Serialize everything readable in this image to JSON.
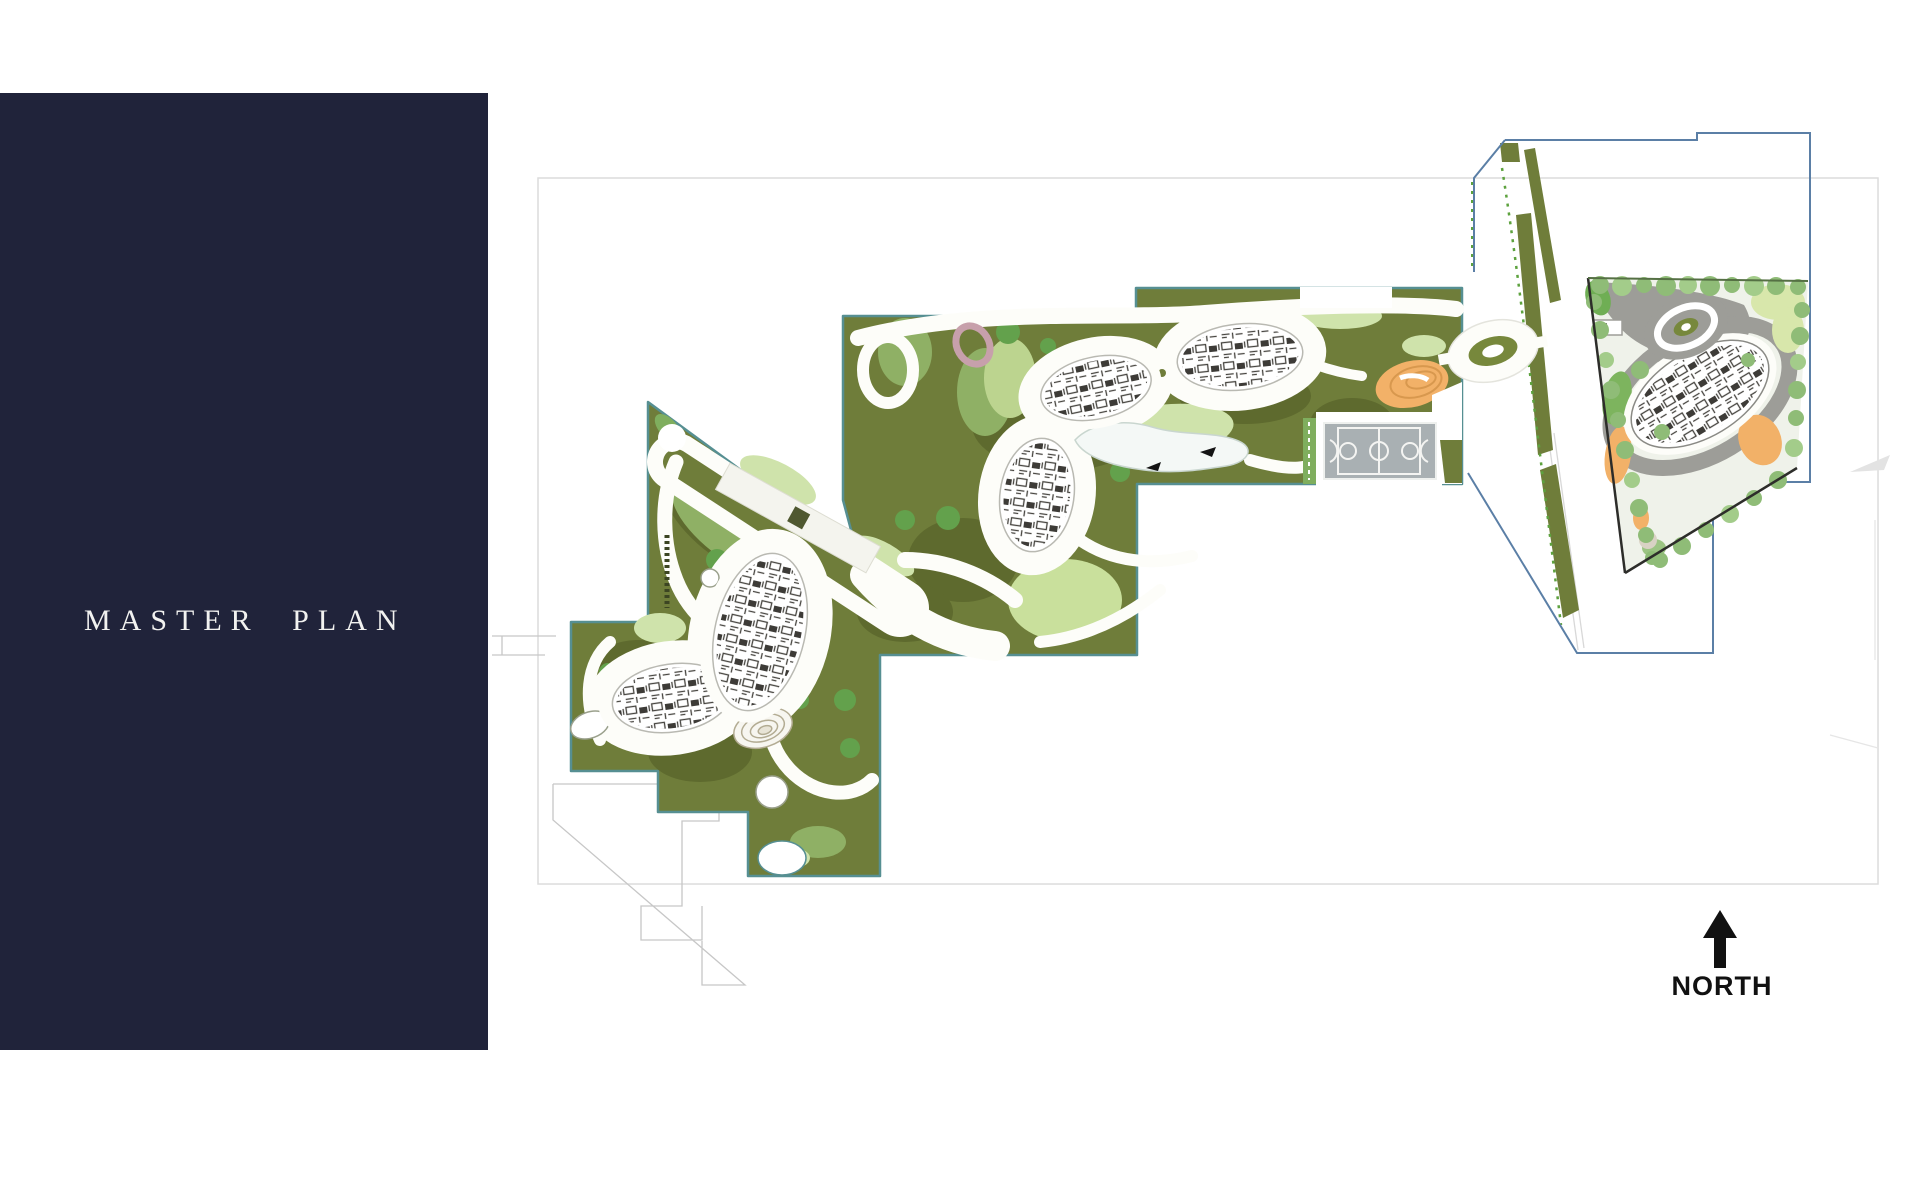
{
  "sidebar": {
    "title": "MASTER PLAN"
  },
  "plan": {
    "north_label": "NORTH",
    "description": "Stepped landscape master plan with three connected green residential parcels (white looping paths, building footprints, lake, spiral mound, basketball court), a diagonal access road corridor, and a separate triangular parcel with grey loop road at the north-east"
  },
  "colors": {
    "panel_navy": "#20233a",
    "title_text": "#f2f2f0",
    "olive": "#6f7d3a",
    "olive_dark": "#5e6a2e",
    "mid_green": "#8fb065",
    "light_green": "#cfe3ab",
    "light_green2": "#c9e09c",
    "tree_green": "#63a14c",
    "sage_tree": "#8fbc77",
    "road_white": "#fdfdf9",
    "gray_road": "#9d9d98",
    "court_gray": "#a9b0b3",
    "orange": "#f2b168",
    "pink_ring": "#c7a0ab",
    "lake_fill": "#f4f8f6",
    "boundary_blue": "#5b7fa6",
    "parcel_border": "#568f92",
    "frame_gray": "#dcdcdc",
    "north_black": "#111111"
  }
}
